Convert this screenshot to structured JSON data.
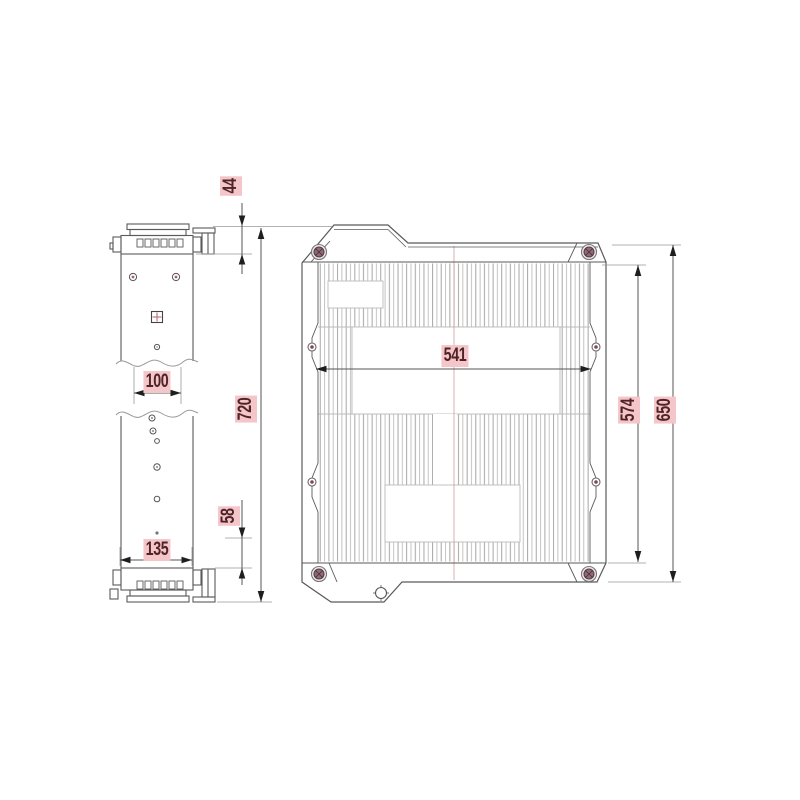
{
  "drawing": {
    "kind": "technical-drawing",
    "views": {
      "side_view": {
        "dimensions": [
          {
            "label": "44",
            "orientation": "vertical"
          },
          {
            "label": "720",
            "orientation": "vertical"
          },
          {
            "label": "100",
            "orientation": "horizontal"
          },
          {
            "label": "135",
            "orientation": "horizontal"
          },
          {
            "label": "58",
            "orientation": "vertical"
          }
        ]
      },
      "front_view": {
        "dimensions": [
          {
            "label": "541",
            "orientation": "horizontal"
          },
          {
            "label": "574",
            "orientation": "vertical"
          },
          {
            "label": "650",
            "orientation": "vertical"
          }
        ]
      }
    },
    "colors": {
      "dimension_highlight": "#f5c6c9",
      "dimension_text": "#4f2427",
      "outline": "#5a5a5a",
      "hatch": "#ababab",
      "bolt_center": "#8d6b74",
      "background": "#ffffff"
    }
  }
}
